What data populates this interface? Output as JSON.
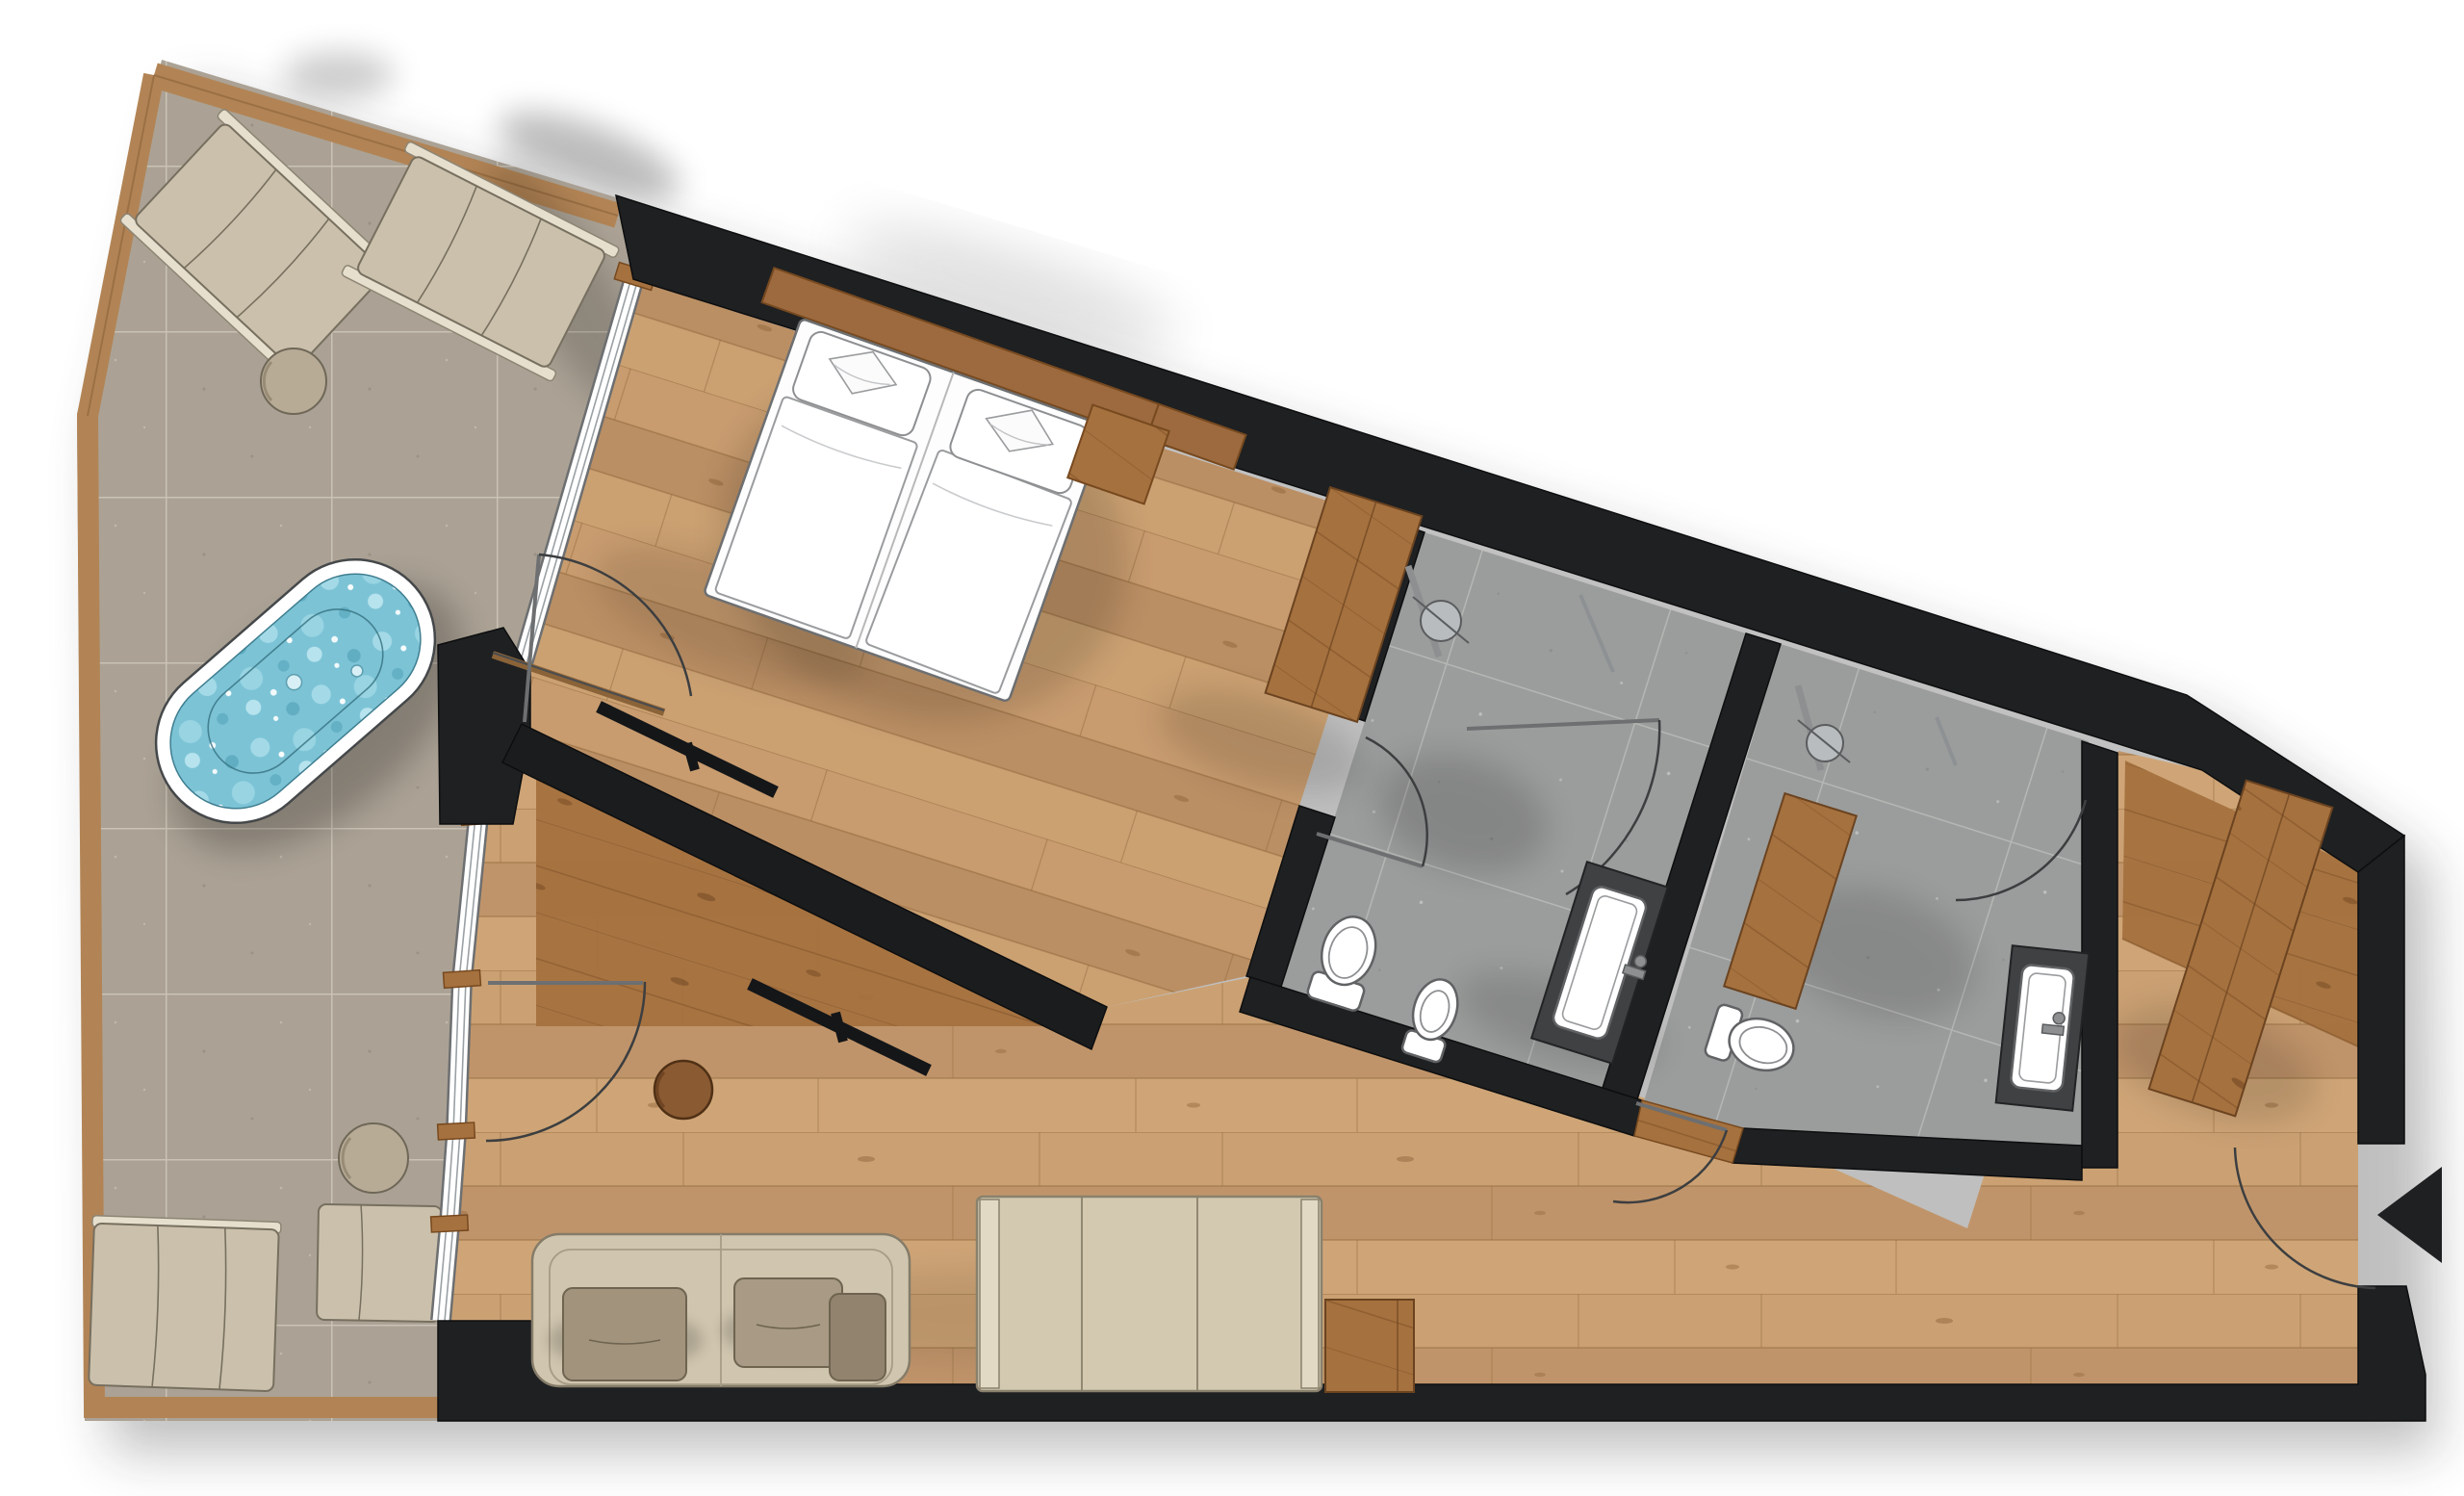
{
  "meta": {
    "title": "Hotel suite floor plan",
    "type": "architectural-floor-plan",
    "view": "top-down",
    "orientation": "wedge-shaped unit, terrace left, entrance right"
  },
  "palette": {
    "background": "#ffffff",
    "wall": "#1e2022",
    "partition": "#1a1c1e",
    "wood_floor": "#c79d6f",
    "wood_floor_bedroom": "#c2966a",
    "wood_accent": "#a5713e",
    "wood_border": "#b28455",
    "stone_tile": "#aba295",
    "stone_grout": "#cac3b5",
    "bath_tile": "#9b9d9c",
    "bath_grout": "#b5b7b5",
    "glass_white": "#ffffff",
    "furniture_beige": "#cfc5ae",
    "furniture_taupe": "#a2937d",
    "fixture_white": "#ffffff",
    "counter_dark": "#3f4143",
    "water": "#7cc3d6",
    "water_light": "#b9e4ee",
    "shadow": "#000000"
  },
  "rooms": [
    {
      "id": "terrace",
      "label": "Terrace",
      "floor": "stone-tile",
      "items": [
        "sun-lounger",
        "sun-lounger",
        "round-side-table",
        "outdoor-bathtub",
        "lounge-bed",
        "ottoman",
        "round-side-table"
      ]
    },
    {
      "id": "bedroom",
      "label": "Bedroom",
      "floor": "oak-plank",
      "items": [
        "double-bed",
        "pillow",
        "pillow",
        "duvet",
        "duvet",
        "headboard-panel",
        "nightstand-panel",
        "tv-panel"
      ]
    },
    {
      "id": "living-room",
      "label": "Living room",
      "floor": "oak-plank",
      "items": [
        "sofa",
        "cushion",
        "cushion",
        "cushion",
        "daybed",
        "side-table-wood",
        "round-coffee-table",
        "tv-panel",
        "media-partition",
        "fireplace-column"
      ]
    },
    {
      "id": "bathroom-1",
      "label": "Bathroom 1",
      "floor": "gray-tile",
      "items": [
        "walk-in-shower",
        "shower-head",
        "toilet",
        "bidet",
        "vanity-sink",
        "glass-partition"
      ]
    },
    {
      "id": "bathroom-2",
      "label": "Bathroom 2",
      "floor": "gray-tile",
      "items": [
        "walk-in-shower",
        "shower-head",
        "wood-bench",
        "toilet",
        "vanity-sink",
        "glass-partition"
      ]
    },
    {
      "id": "entrance-hall",
      "label": "Entrance hall",
      "floor": "oak-plank",
      "items": [
        "wardrobe",
        "entry-door"
      ]
    }
  ],
  "annotations": {
    "entrance_marker": "entrance-arrow",
    "door_swing_arcs": 8,
    "window_band": "glazed wall between terrace and interior, 5 segments",
    "walls": "solid black poche"
  }
}
